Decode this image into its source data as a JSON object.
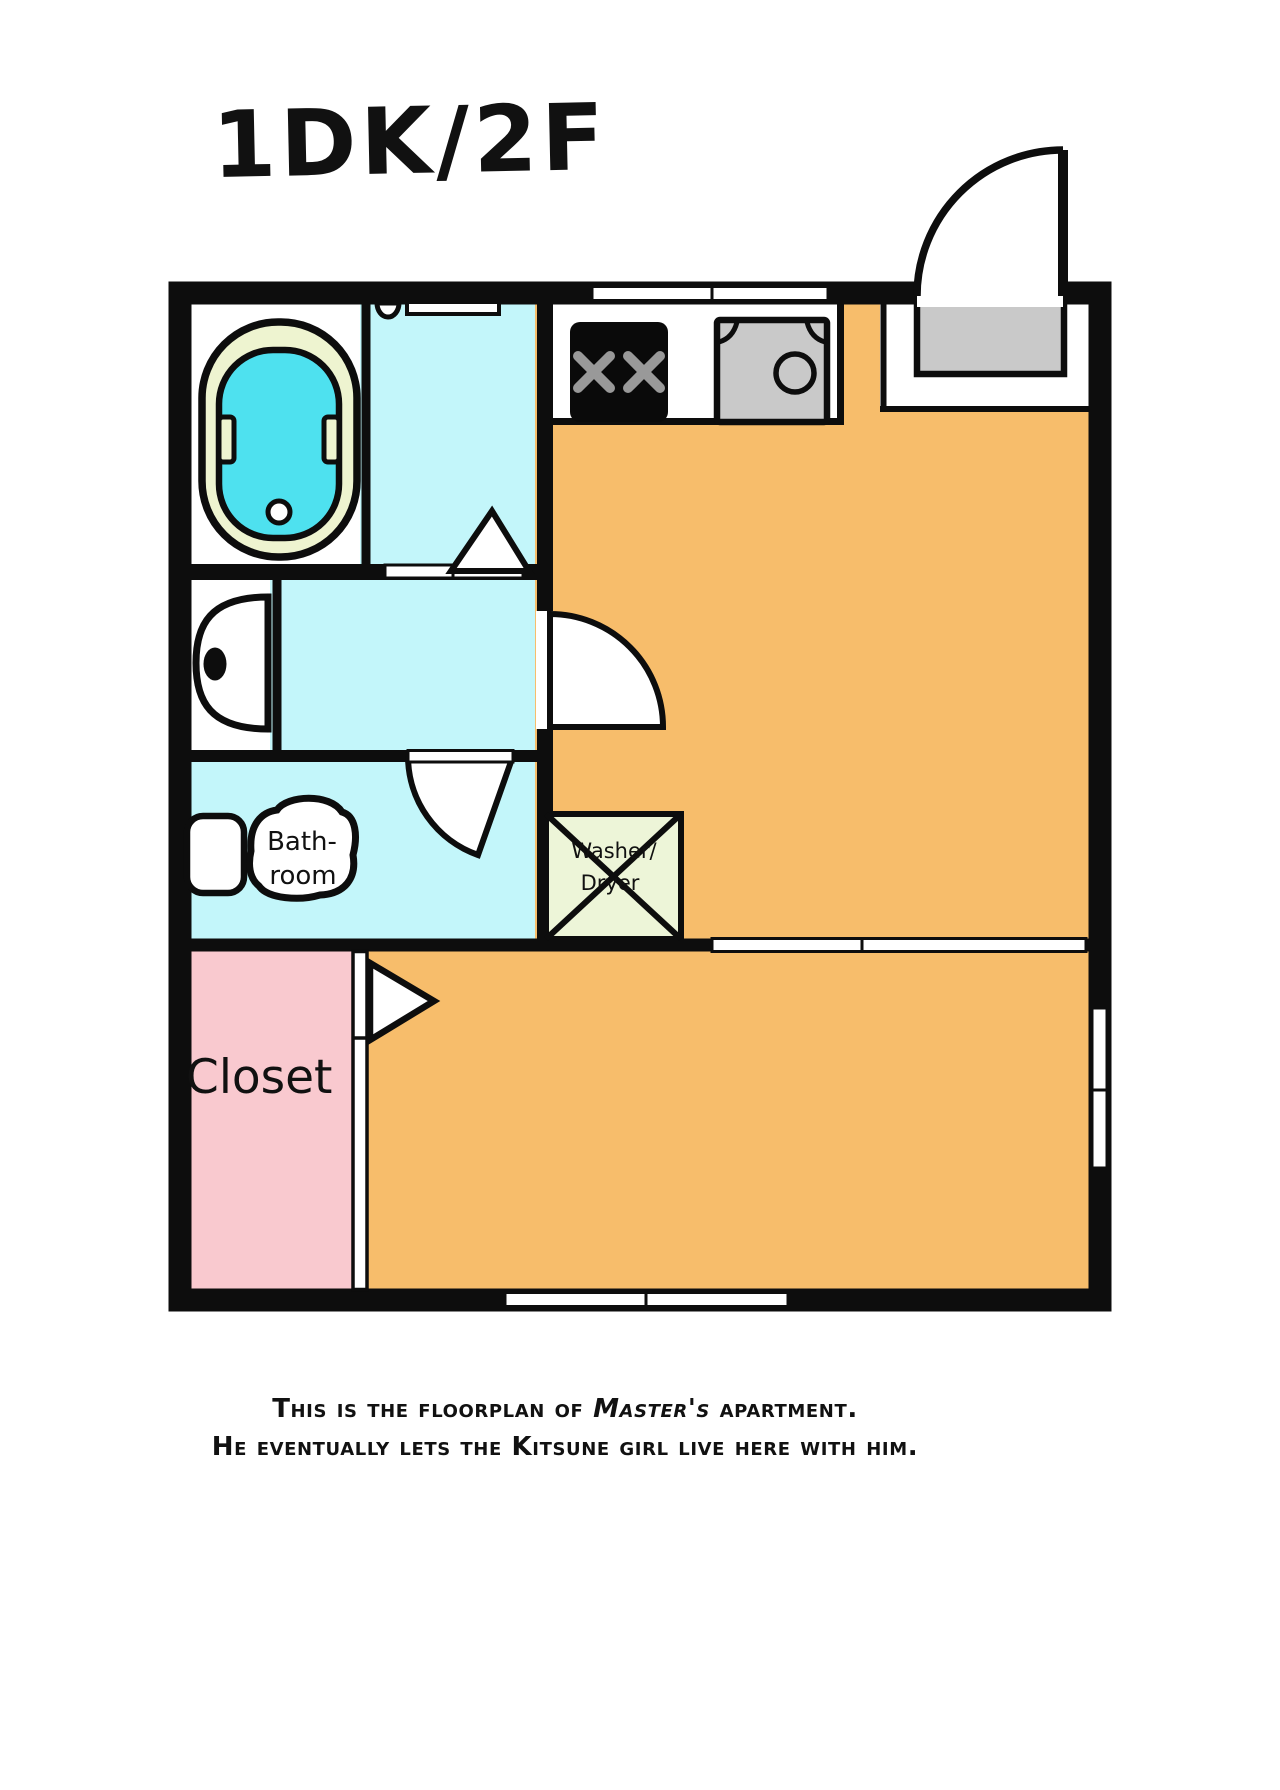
{
  "title": "1DK/2F",
  "floorplan": {
    "labels": {
      "closet": "Closet",
      "bathroom_line1": "Bath-",
      "bathroom_line2": "room",
      "washer_line1": "Washer/",
      "washer_line2": "Dryer"
    }
  },
  "caption": {
    "line1_prefix": "This is the floorplan of ",
    "line1_emphasis": "Master's",
    "line1_suffix": " apartment.",
    "line2": "He eventually lets the Kitsune girl live here with him."
  },
  "colors": {
    "ink": "#0d0d0d",
    "wet_area_floor": "#c3f6fa",
    "bathtub_water": "#4ee1ef",
    "bathtub_rim": "#eef4d0",
    "living_floor": "#f7bd6b",
    "closet_floor": "#f9c9cf",
    "entry_mat": "#c9c9c9",
    "washer_box": "#edf5d8",
    "stove": "#0a0a0a",
    "burner_marks": "#999999"
  }
}
